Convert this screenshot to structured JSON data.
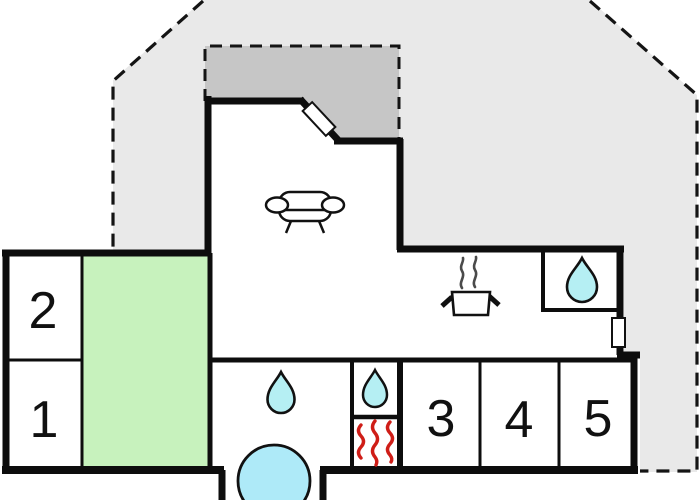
{
  "plan": {
    "type": "floor-plan",
    "rooms": {
      "room1": {
        "label": "1"
      },
      "room2": {
        "label": "2"
      },
      "room3": {
        "label": "3"
      },
      "room4": {
        "label": "4"
      },
      "room5": {
        "label": "5"
      }
    },
    "icons": [
      "sofa-icon",
      "cooking-pot-icon",
      "steam-icon",
      "water-drop-icon-shower",
      "water-drop-icon-bathroom",
      "water-drop-icon-tech",
      "heater-icon",
      "hot-tub-icon",
      "door-icon",
      "window-icon"
    ],
    "colors": {
      "lot": "#e9e9e9",
      "terrace": "#c6c6c6",
      "green_room": "#c7f2bd",
      "water": "#b5eff3",
      "hot_tub": "#aeeaf8",
      "heater": "#cf1d17",
      "wall": "#0d0d0d",
      "interior": "#ffffff"
    }
  }
}
